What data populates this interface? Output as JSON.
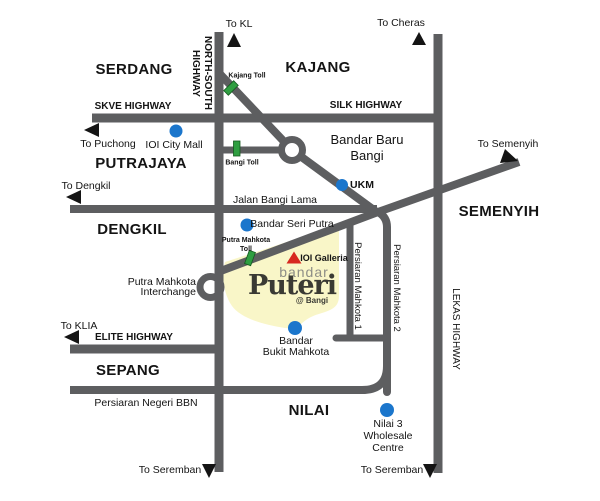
{
  "regions": {
    "serdang": "SERDANG",
    "kajang": "KAJANG",
    "putrajaya": "PUTRAJAYA",
    "dengkil": "DENGKIL",
    "semenyih": "SEMENYIH",
    "sepang": "SEPANG",
    "nilai": "NILAI"
  },
  "roads": {
    "skve": "SKVE HIGHWAY",
    "silk": "SILK HIGHWAY",
    "north_south_line1": "NORTH-SOUTH",
    "north_south_line2": "HIGHWAY",
    "elite": "ELITE HIGHWAY",
    "lekas": "LEKAS HIGHWAY",
    "jalan_bangi_lama": "Jalan Bangi Lama",
    "persiaran_negeri_bbn": "Persiaran Negeri BBN",
    "persiaran_mahkota_1": "Persiaran Mahkota 1",
    "persiaran_mahkota_2": "Persiaran Mahkota 2"
  },
  "directions": {
    "to_kl": "To KL",
    "to_cheras": "To Cheras",
    "to_puchong": "To Puchong",
    "to_dengkil": "To Dengkil",
    "to_semenyih": "To Semenyih",
    "to_klia": "To KLIA",
    "to_seremban_west": "To Seremban",
    "to_seremban_east": "To Seremban"
  },
  "tolls": {
    "kajang": "Kajang Toll",
    "bangi": "Bangi Toll",
    "putra_mahkota_line1": "Putra Mahkota",
    "putra_mahkota_line2": "Toll"
  },
  "places": {
    "ioi_city_mall": "IOI City Mall",
    "bandar_baru_bangi_line1": "Bandar Baru",
    "bandar_baru_bangi_line2": "Bangi",
    "ukm": "UKM",
    "bandar_seri_putra": "Bandar Seri Putra",
    "ioi_galleria": "IOI Galleria",
    "interchange_line1": "Putra Mahkota",
    "interchange_line2": "Interchange",
    "bukit_mahkota_line1": "Bandar",
    "bukit_mahkota_line2": "Bukit Mahkota",
    "nilai3_line1": "Nilai 3",
    "nilai3_line2": "Wholesale",
    "nilai3_line3": "Centre"
  },
  "logo": {
    "line1": "bandar",
    "line2": "Puteri",
    "line3": "@ Bangi"
  },
  "colors": {
    "road": "#5d5e60",
    "township_fill": "#f9f6c8",
    "poi_marker": "#1b76cc",
    "toll_marker": "#2f9e41",
    "landmark_marker": "#d7281f",
    "arrow": "#141414"
  }
}
